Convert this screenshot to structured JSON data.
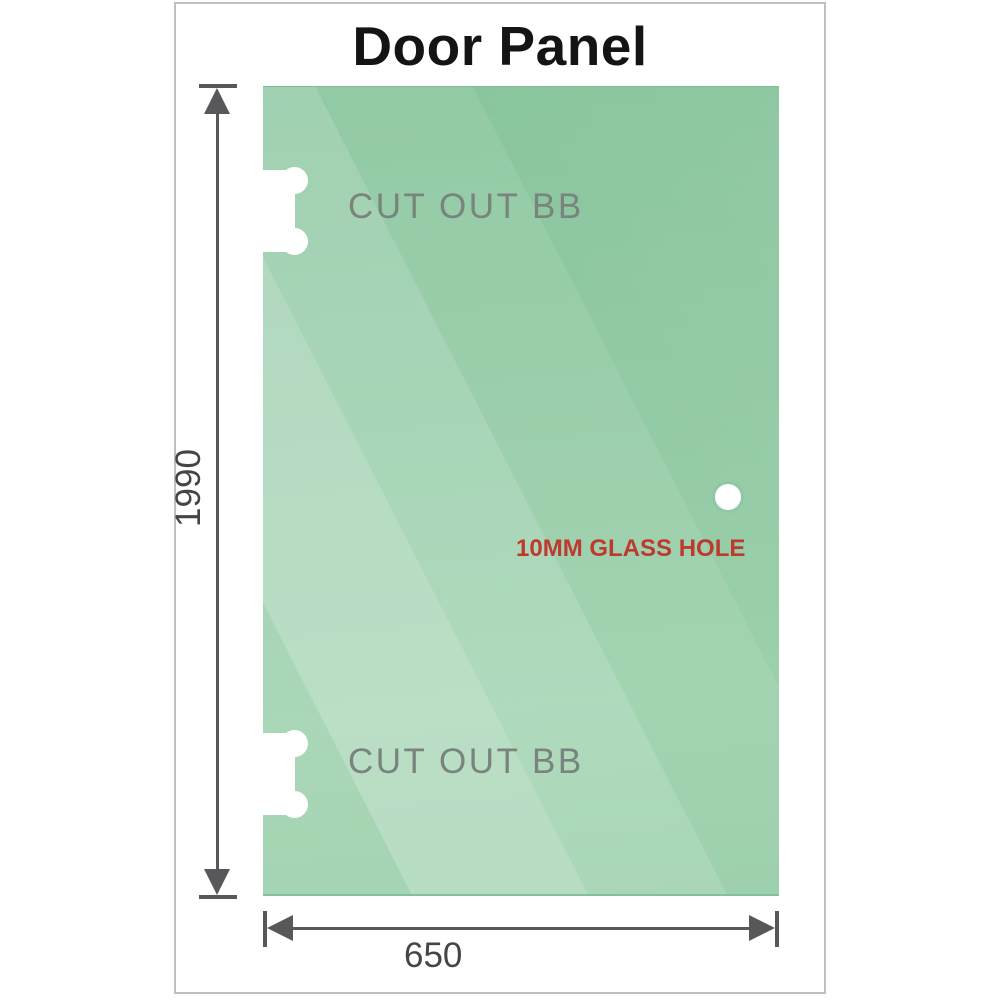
{
  "title": "Door Panel",
  "panel": {
    "cutouts": [
      {
        "label": "CUT OUT BB"
      },
      {
        "label": "CUT OUT BB"
      }
    ],
    "glass_hole": {
      "label": "10MM GLASS HOLE"
    }
  },
  "dimensions": {
    "height": {
      "value": "1990"
    },
    "width": {
      "value": "650"
    }
  },
  "colors": {
    "glass_base": "#90c9a3",
    "glass_highlight": "#b5dec1",
    "dimension_line": "#58585a",
    "dimension_text": "#454545",
    "cutout_label": "#78847d",
    "hole_label": "#bd3a2e",
    "title_text": "#141414",
    "frame_border": "#bfbfbf"
  }
}
